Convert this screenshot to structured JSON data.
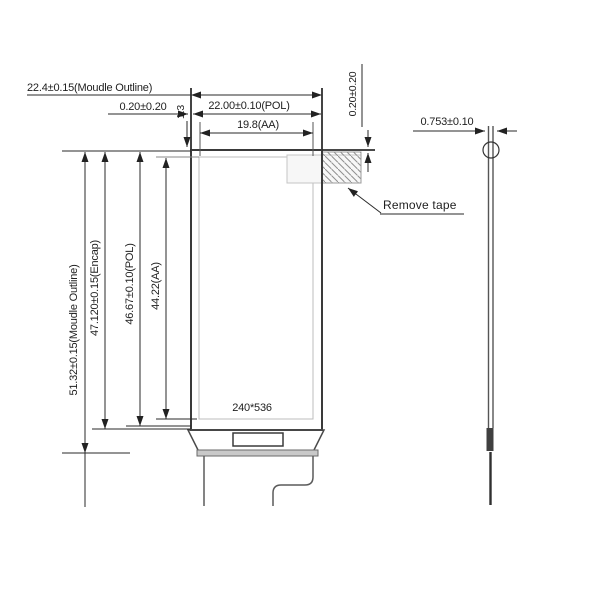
{
  "drawing": {
    "dims": {
      "module_w": "22.4±0.15(Moudle Outline)",
      "pol_w": "22.00±0.10(POL)",
      "aa_w": "19.8(AA)",
      "gap_left": "0.20±0.20",
      "gap_right": "0.20±0.20",
      "offset_top": "1.3",
      "module_h": "51.32±0.15(Moudle Outline)",
      "encap_h": "47.120±0.15(Encap)",
      "pol_h": "46.67±0.10(POL)",
      "aa_h": "44.22(AA)",
      "thickness": "0.753±0.10"
    },
    "labels": {
      "resolution": "240*536",
      "remove_tape": "Remove tape"
    },
    "colors": {
      "outline": "#3a3a3a",
      "dimension": "#222222",
      "construction": "#bcbcbc",
      "hatch": "#8f8f8f",
      "bond_strip": "#c9c9c9",
      "background": "#ffffff"
    }
  }
}
